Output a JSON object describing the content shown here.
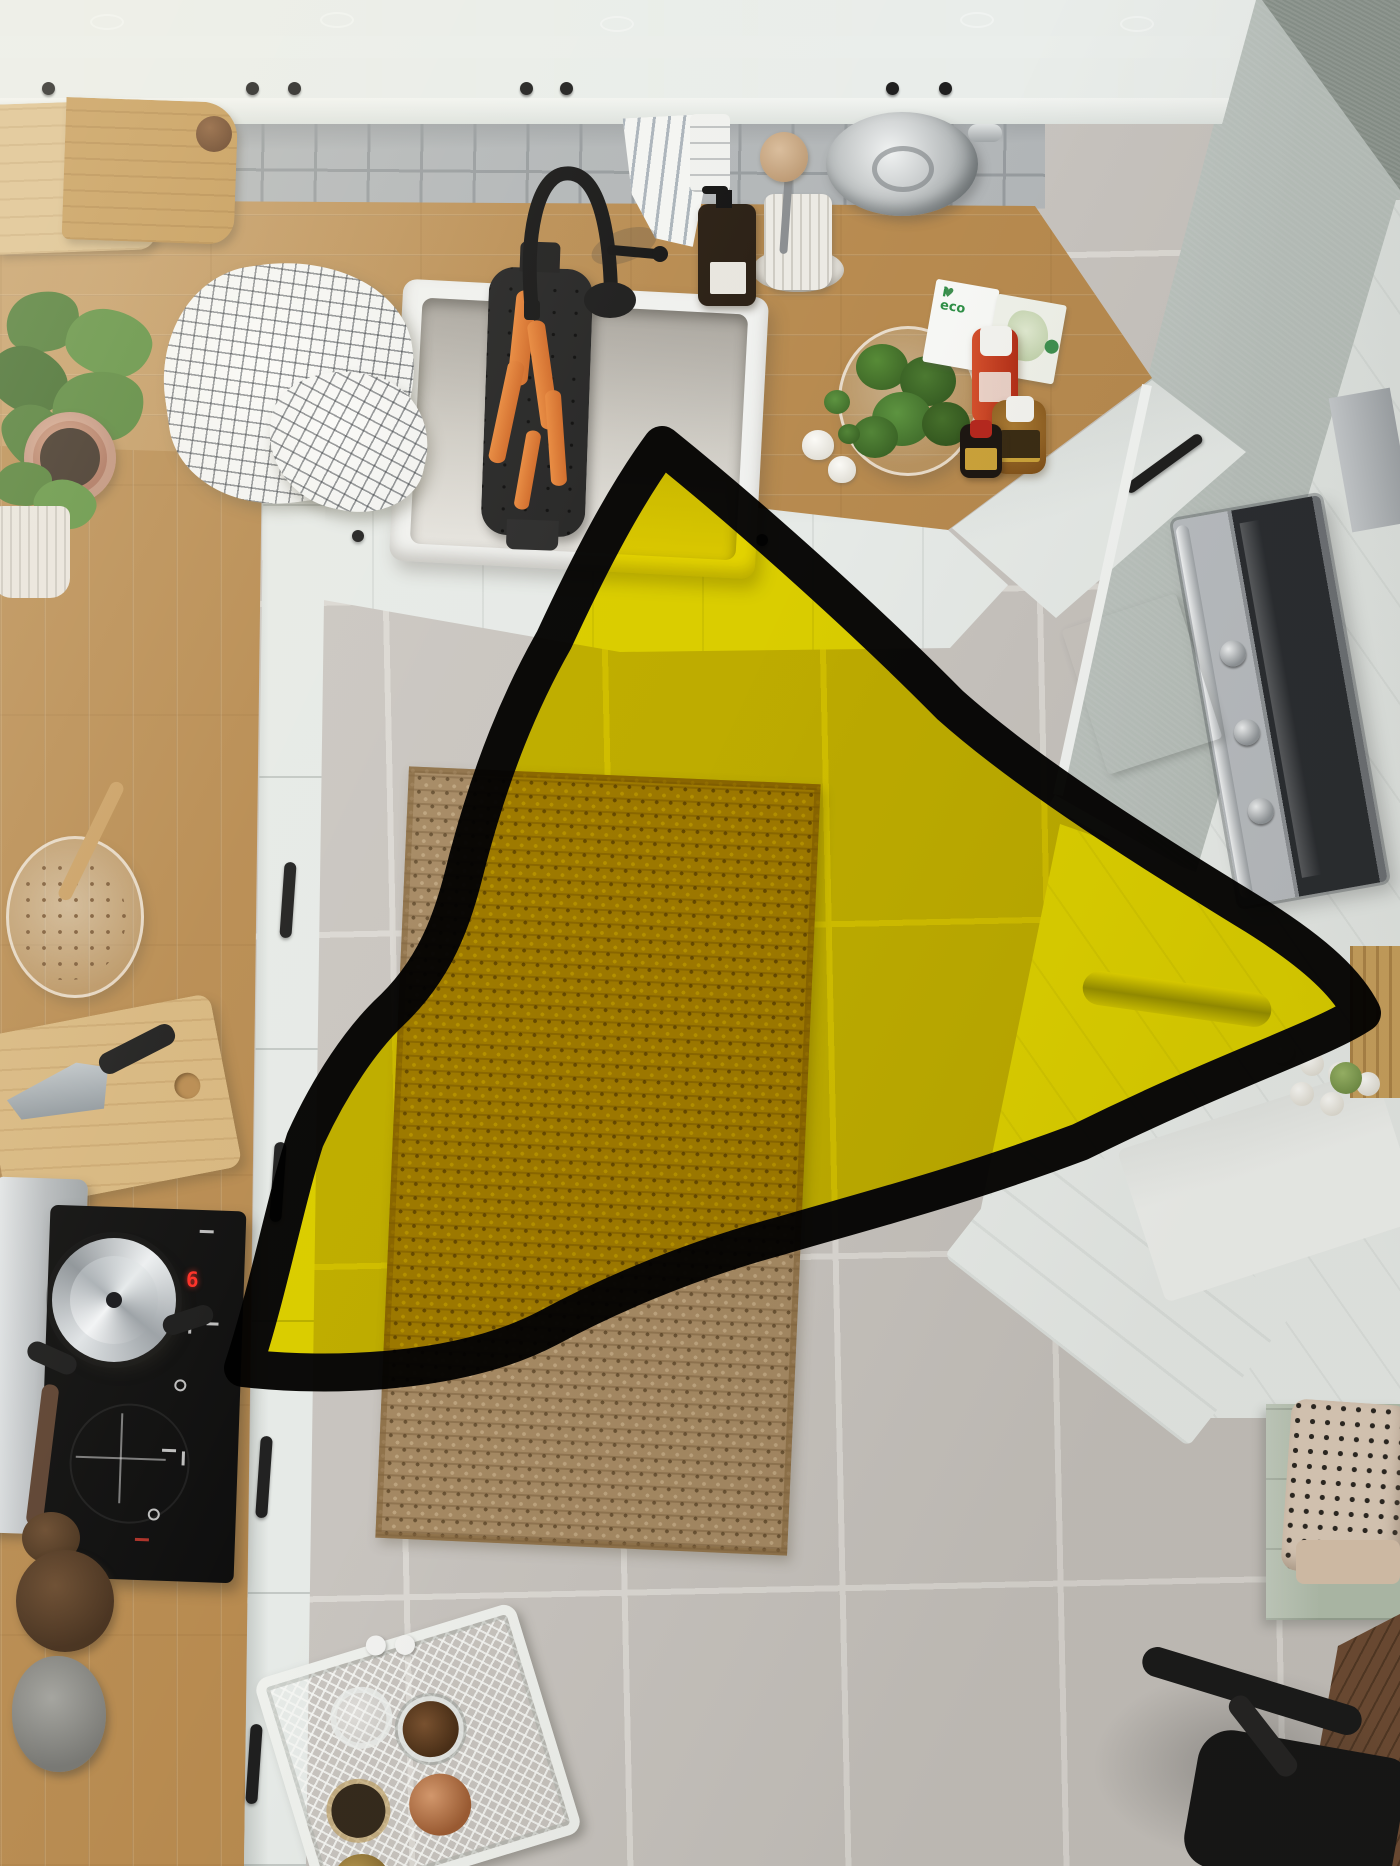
{
  "meta": {
    "description": "Top-down photo of a white country-style kitchen with wood worktops; a large hand-drawn yellow triangle with a thick black border is overlaid on the centre of the floor",
    "canvas": {
      "width": 1400,
      "height": 1866
    }
  },
  "texts": {
    "cooktop_display": "6",
    "eco_card_word": "eco",
    "eco_card_i": "i",
    "eco_card_heart": "♥"
  },
  "colors": {
    "overlay-yellow": "#f2e000",
    "overlay-border": "#0d0c0a",
    "floor-tile": "#c7c3be",
    "floor-grout": "#dbd8d3",
    "wood": "#b78a4f",
    "cab-white": "#e9edea",
    "cab-front": "#e6eae7",
    "wall-sage": "#b7bfba",
    "wall-dark": "#879089",
    "splash-tile": "#b2b6b8",
    "splash-grout": "#969b9e",
    "sink-white": "#f0f1ef",
    "steel": "#b9bdc1",
    "oven-glass": "#2a2d31",
    "rug": "#a58963",
    "bench-green": "#b3c0ae",
    "carrot-orange": "#e0762e",
    "cooktop-digit-red": "#ff2e24"
  },
  "overlay": {
    "shape": "triangle",
    "style": "hand-drawn, rounded corners, wavy edges",
    "blend": "multiply",
    "border_width": 38,
    "vertices": [
      [
        662,
        445
      ],
      [
        1362,
        1013
      ],
      [
        243,
        1368
      ]
    ],
    "path": "M662,445 C755,520 868,622 950,705 C1032,778 1152,852 1256,916 C1318,955 1348,985 1362,1013 C1322,1040 1230,1068 1080,1142 C960,1187 858,1213 780,1236 C680,1263 600,1300 548,1328 C460,1374 330,1378 243,1368 C268,1292 284,1206 305,1140 C330,1085 362,1038 392,1010 C442,962 456,906 468,858 C492,768 520,700 554,640 C592,558 626,494 662,445 Z"
  },
  "objects": [
    "glass-door wall cabinets with wine glasses",
    "grey square-tile backsplash",
    "oak worktop with white farmhouse sink",
    "black faucet and black colander with carrots",
    "checkered and striped tea towels",
    "steel colander, brush cup, soap bottle, plate stack",
    "glass bowl of broccoli, garlic, condiment bottles, eco booklet",
    "sage wall and tall cabinet with stainless oven",
    "kitchen island with open door, eggs and chopping boards",
    "jute rug on grey tile floor",
    "induction cooktop with pot and roasting tray",
    "cutting board with santoku knife, bowl of dried flowers, potted plants",
    "white mesh cart with spice jars",
    "green bench with dotted cushion, walnut table corner, black chair"
  ]
}
